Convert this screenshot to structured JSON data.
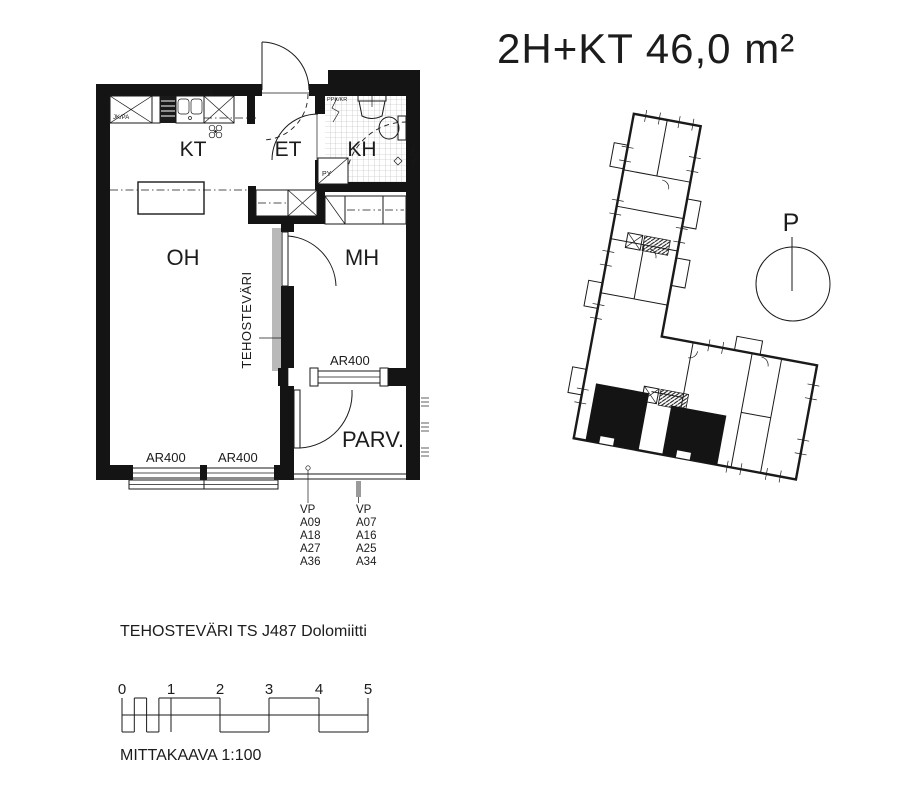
{
  "title": "2H+KT 46,0 m²",
  "colors": {
    "line": "#1a1a1a",
    "wall_fill": "#141414",
    "accent_gray": "#b9b9b9",
    "tile_grid": "#b5b5b5"
  },
  "plan": {
    "room_labels": {
      "kt": "KT",
      "et": "ET",
      "kh": "KH",
      "oh": "OH",
      "mh": "MH",
      "parv": "PARV."
    },
    "accent_wall_label": "TEHOSTEVÄRI",
    "window_labels": {
      "oh_left": "AR400",
      "oh_right": "AR400",
      "mh": "AR400"
    },
    "fixture_labels": {
      "fridge": "JK/PA",
      "stove": "L",
      "washer": "PPK/KR",
      "laundry": "PY"
    },
    "vp_left": {
      "header": "VP",
      "items": [
        "A09",
        "A18",
        "A27",
        "A36"
      ]
    },
    "vp_right": {
      "header": "VP",
      "items": [
        "A07",
        "A16",
        "A25",
        "A34"
      ]
    }
  },
  "overview": {
    "compass_label": "P"
  },
  "footer": {
    "accent_note": "TEHOSTEVÄRI TS J487 Dolomiitti",
    "scale_numbers": [
      "0",
      "1",
      "2",
      "3",
      "4",
      "5"
    ],
    "scale_caption": "MITTAKAAVA 1:100"
  }
}
